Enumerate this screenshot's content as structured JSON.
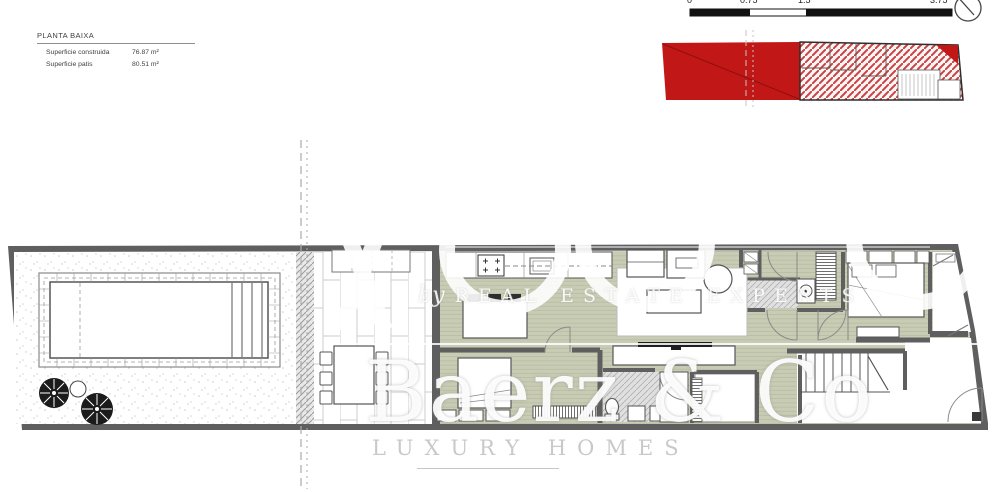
{
  "title_block": {
    "title": "PLANTA BAIXA",
    "rows": [
      {
        "label": "Superficie construida",
        "value": "76.87 m²"
      },
      {
        "label": "Superficie patis",
        "value": "80.51 m²"
      }
    ]
  },
  "scale_bar": {
    "ticks": [
      "0",
      "0.75",
      "1.5",
      "3.75"
    ]
  },
  "watermark": {
    "byline_prefix": "by",
    "byline": "REAL ESTATE EXPERTS",
    "brand": "Baerz & Co",
    "tagline": "LUXURY HOMES"
  },
  "key_plan": {
    "highlight_color": "#c21717"
  },
  "colors": {
    "wall": "#5f5f5f",
    "floor_wood": "#c9ccb4",
    "tile": "#e0e0e0",
    "red": "#c21717"
  }
}
